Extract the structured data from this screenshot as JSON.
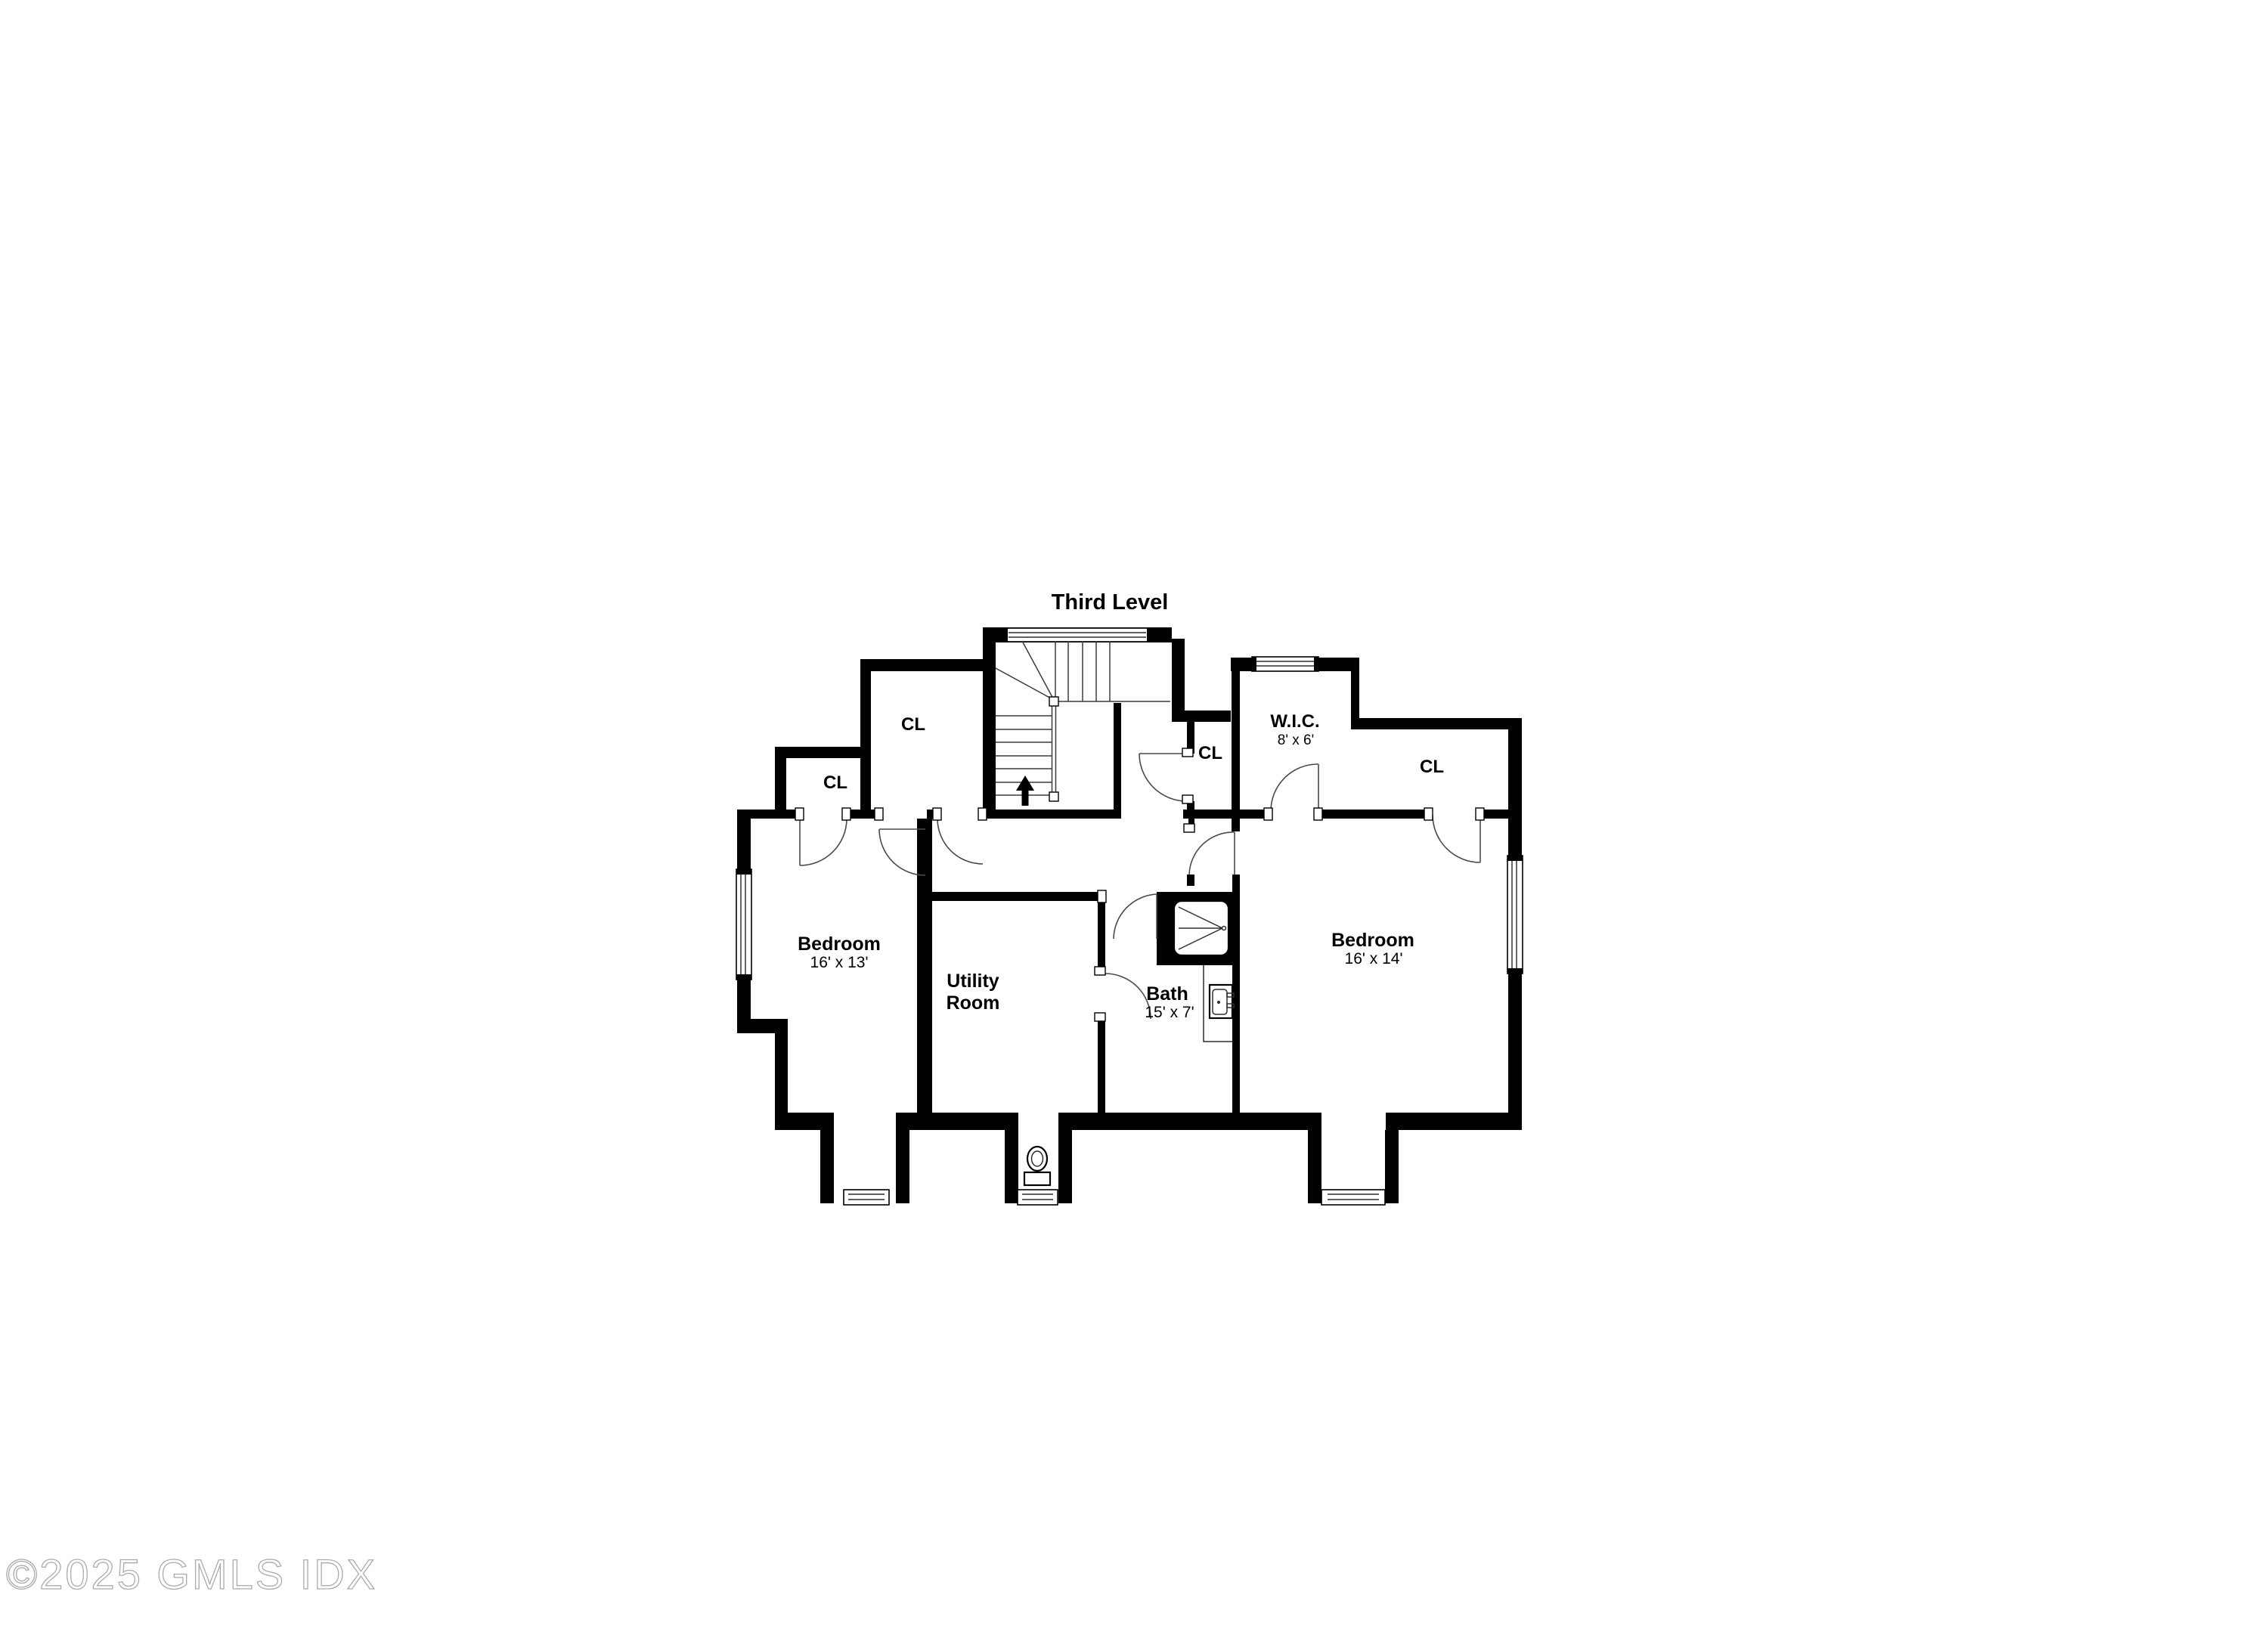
{
  "title": "Third Level",
  "watermark": "©2025 GMLS IDX",
  "colors": {
    "background": "#ffffff",
    "walls": "#000000",
    "door_lines": "#4a4a4a",
    "watermark": "#ababab"
  },
  "rooms": {
    "bedroom_left": {
      "name": "Bedroom",
      "dims": "16' x 13'"
    },
    "bedroom_right": {
      "name": "Bedroom",
      "dims": "16' x 14'"
    },
    "utility_room": {
      "name_line1": "Utility",
      "name_line2": "Room"
    },
    "bath": {
      "name": "Bath",
      "dims": "15' x 7'"
    },
    "wic": {
      "name": "W.I.C.",
      "dims": "8' x 6'"
    },
    "closet_upper_left": {
      "label": "CL"
    },
    "closet_left": {
      "label": "CL"
    },
    "closet_center": {
      "label": "CL"
    },
    "closet_right": {
      "label": "CL"
    }
  },
  "stairs": {
    "arrow_direction": "up"
  }
}
